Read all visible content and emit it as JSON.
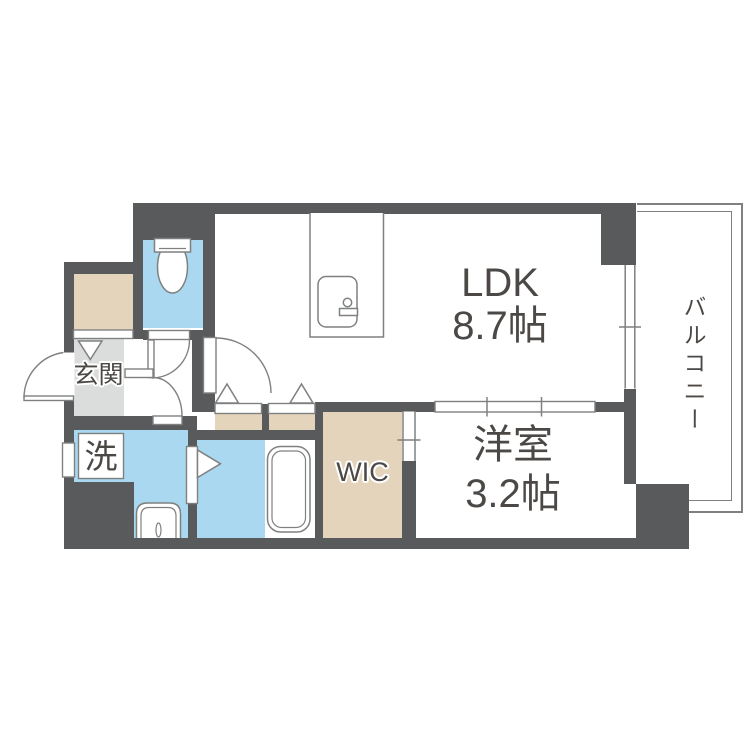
{
  "title": "1LDK apartment floor plan",
  "colors": {
    "wall": "#595a5c",
    "water": "#a9d8f0",
    "storage": "#e5d4bc",
    "entrance_floor": "#dbdcdc",
    "outline": "#7f8080",
    "text": "#4b4846",
    "background": "#ffffff"
  },
  "rooms": {
    "ldk": {
      "line1": "LDK",
      "line2": "8.7帖"
    },
    "western_room": {
      "line1": "洋室",
      "line2": "3.2帖"
    },
    "wic": {
      "label": "WIC"
    },
    "entrance": {
      "label": "玄関"
    },
    "laundry": {
      "label": "洗"
    },
    "balcony": {
      "label": "バルコニー"
    }
  },
  "fixtures": [
    "toilet",
    "bathtub",
    "washbasin",
    "kitchen-counter",
    "kitchen-stove",
    "washing-machine-space"
  ]
}
